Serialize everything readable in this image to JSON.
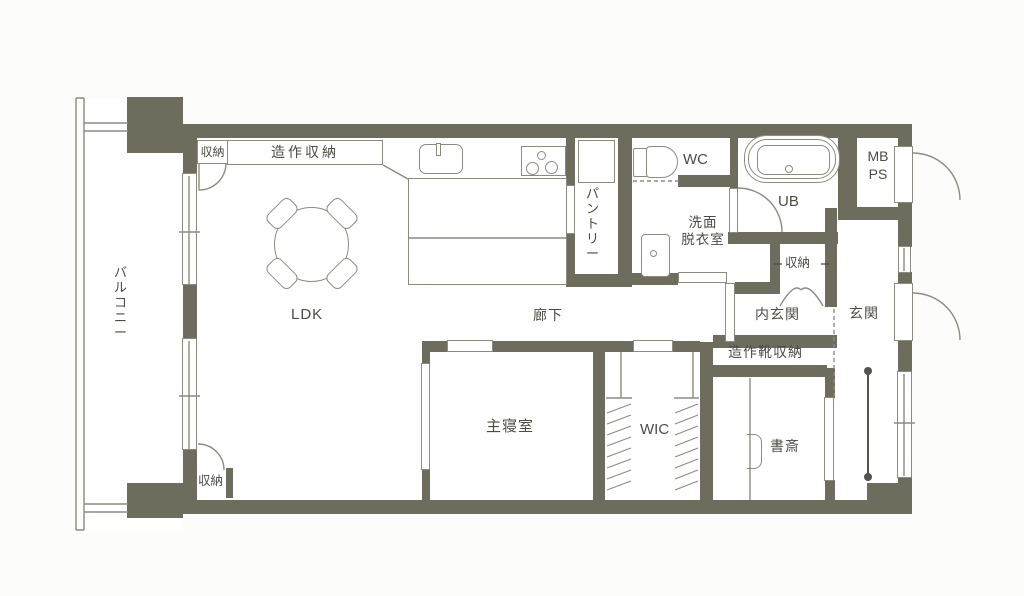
{
  "title": "apartment-floor-plan",
  "colors": {
    "wall": "#6e6c5d",
    "outline": "#8d8b7e",
    "text": "#4d4b42",
    "floor": "#ffffff",
    "background": "#fcfcfa"
  },
  "rooms": {
    "balcony": {
      "label": "バルコニー"
    },
    "ldk": {
      "label": "LDK"
    },
    "corridor": {
      "label": "廊下"
    },
    "bedroom": {
      "label": "主寝室"
    },
    "wic": {
      "label": "WIC"
    },
    "study": {
      "label": "書斎"
    },
    "pantry": {
      "label": "パントリー"
    },
    "wc": {
      "label": "WC"
    },
    "bathroom": {
      "label": "UB"
    },
    "mbps": {
      "label": "MB\nPS"
    },
    "washroom": {
      "label": "洗面\n脱衣室"
    },
    "inner_genkan": {
      "label": "内玄関"
    },
    "genkan": {
      "label": "玄関"
    },
    "shoe_storage": {
      "label": "造作靴収納"
    },
    "built_in_storage": {
      "label": "造作収納"
    },
    "storage_top_left": {
      "label": "収納"
    },
    "storage_genkan": {
      "label": "収納"
    },
    "storage_ldk": {
      "label": "収納"
    }
  },
  "fixtures": {
    "dining_table": "round-table-with-4-chairs",
    "kitchen_sink": "sink-with-faucet",
    "kitchen_stove": "3-burner-stove",
    "kitchen_island": "counter-island",
    "pantry_shelf": "shelf",
    "toilet": "toilet",
    "bathtub": "bathtub",
    "washbasin": "washbasin",
    "desk_chair": "study-chair",
    "handrail": "genkan-handrail",
    "wic_hangers": "hanger-pipes-both-sides"
  }
}
